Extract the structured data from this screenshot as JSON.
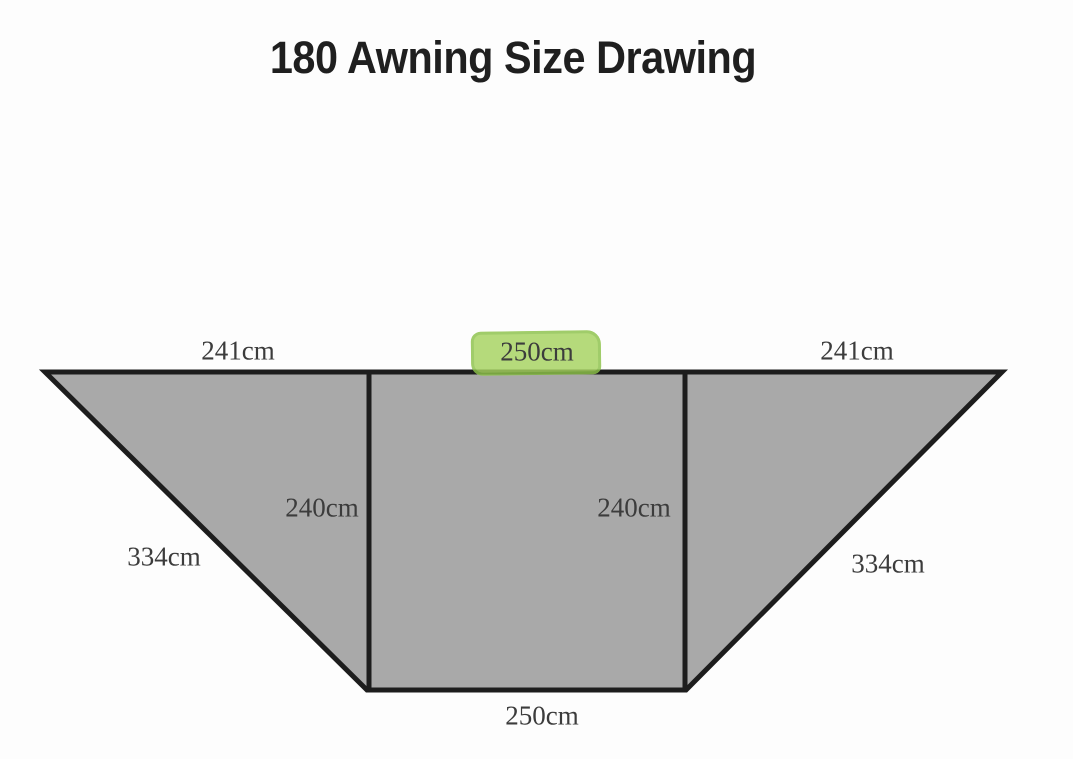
{
  "title": "180 Awning Size Drawing",
  "labels": {
    "top_left_width": "241cm",
    "top_center_width": "250cm",
    "top_right_width": "241cm",
    "left_panel_height": "240cm",
    "right_panel_height": "240cm",
    "left_slant_length": "334cm",
    "right_slant_length": "334cm",
    "bottom_width": "250cm"
  },
  "colors": {
    "canvas-bg": "#fdfdfd",
    "shape-fill": "#a9a9a9",
    "shape-outline": "#1d1d1d",
    "highlight-green": "#a6d35f",
    "highlight-edge": "#8cc24a",
    "label-color": "#3c3c3c",
    "title-color": "#1f1f1f"
  }
}
